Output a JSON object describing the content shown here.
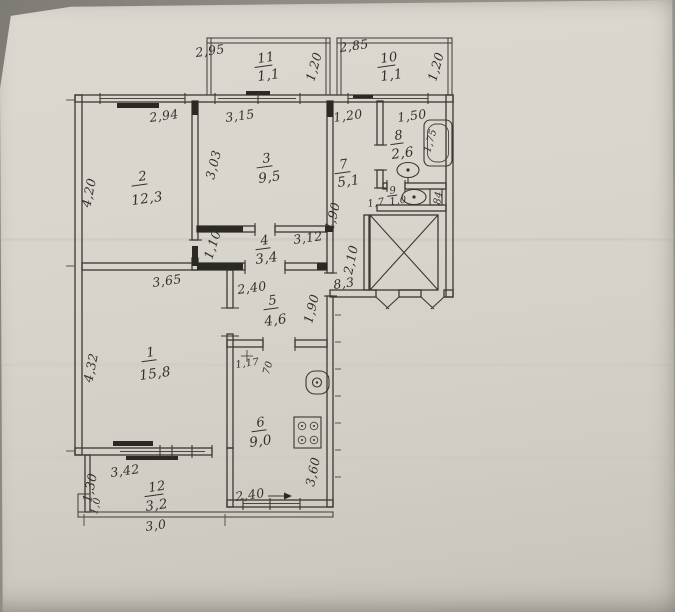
{
  "colors": {
    "ink": "#35332c",
    "paper": "#d8d4cb"
  },
  "plan": {
    "rooms": {
      "r1": {
        "number": "1",
        "area": "15,8"
      },
      "r2": {
        "number": "2",
        "area": "12,3"
      },
      "r3": {
        "number": "3",
        "area": "9,5"
      },
      "r4": {
        "number": "4",
        "area": "3,4"
      },
      "r5": {
        "number": "5",
        "area": "4,6"
      },
      "r6": {
        "number": "6",
        "area": "9,0"
      },
      "r7": {
        "number": "7",
        "area": "5,1"
      },
      "r8": {
        "number": "8",
        "area": "2,6"
      },
      "r9": {
        "number": "9",
        "area": "1,0"
      },
      "r10": {
        "number": "10",
        "area": "1,1"
      },
      "r11": {
        "number": "11",
        "area": "1,1"
      },
      "r12": {
        "number": "12",
        "area": "3,2"
      }
    },
    "dims": {
      "balcony11_width": "2,95",
      "balcony11_depth": "1,20",
      "balcony10_width": "2,85",
      "balcony10_depth": "1,20",
      "room2_width": "2,94",
      "room2_depth": "4,20",
      "room3_width": "3,15",
      "room3_depth": "3,03",
      "hall_width": "1,20",
      "bath_width": "1,50",
      "bathtub_length": "1,75",
      "corridor4_width": "3,12",
      "corridor4_depth": "1,10",
      "hall_depth": "4,90",
      "wc_door": "1,7",
      "wc_width": "84",
      "shaft_depth": "2,10",
      "stairs_area": "8,3",
      "room1_width": "3,65",
      "room1_depth": "4,32",
      "corridor5_width": "2,40",
      "corridor5_depth": "1,90",
      "kitchen_door_offset": "1,17",
      "kitchen_door_width": "70",
      "kitchen_depth": "3,60",
      "kitchen_window_width": "2,40",
      "loggia_width": "3,42",
      "loggia_depth": "1,30",
      "loggia_outer_width": "3,0",
      "loggia_step": "1,0"
    }
  }
}
